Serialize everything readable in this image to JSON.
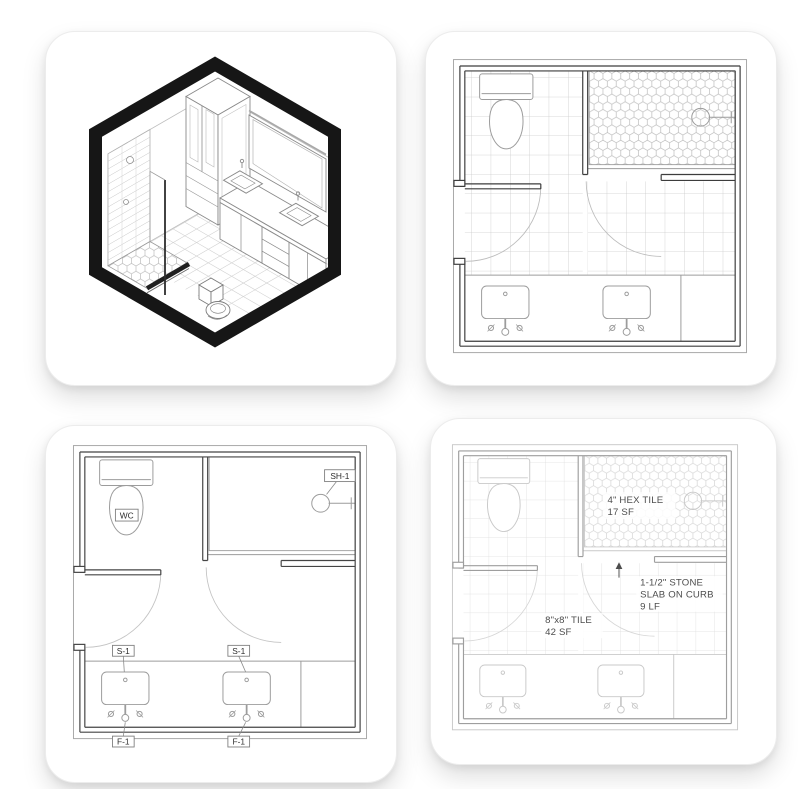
{
  "fixture_plan": {
    "wc_label": "WC",
    "shower_label": "SH-1",
    "sink_label": "S-1",
    "faucet_label": "F-1"
  },
  "finish_plan": {
    "hex_note_line1": "4\" HEX TILE",
    "hex_note_line2": "17 SF",
    "stone_note_line1": "1-1/2\" STONE",
    "stone_note_line2": "SLAB ON CURB",
    "stone_note_line3": "9 LF",
    "floor_note_line1": "8\"x8\" TILE",
    "floor_note_line2": "42 SF"
  },
  "colors": {
    "hexagon_frame": "#161616",
    "wall_dark": "#3d3d3d",
    "wall_light": "#9e9e9e",
    "fixture_gray": "#9c9c9c",
    "label_text": "#2e2e2e",
    "annotation_text": "#4d4d4d",
    "card_background": "#ffffff"
  }
}
